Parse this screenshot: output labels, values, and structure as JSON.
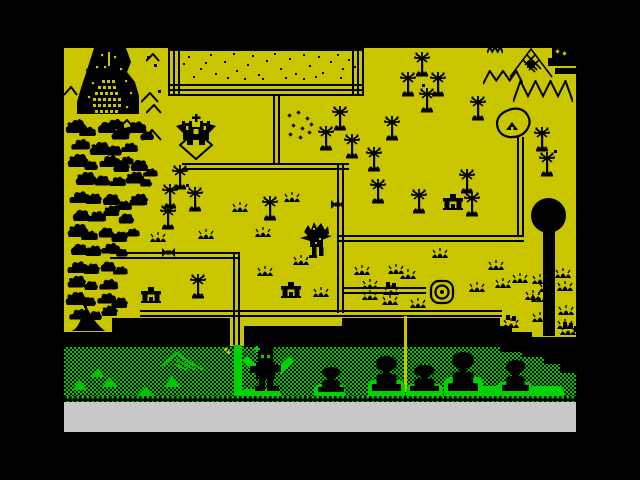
{
  "palette": {
    "yellow": "#c9c600",
    "green": "#00c400",
    "bright_green": "#00d400",
    "gray": "#c8c8c8",
    "black": "#000000"
  },
  "scene": {
    "screen": {
      "x": 64,
      "y": 48,
      "w": 512,
      "h": 384
    },
    "map": {
      "x": 64,
      "y": 48,
      "w": 512,
      "h": 270
    },
    "yellow_patches": [
      [
        64,
        318,
        48,
        14
      ],
      [
        238,
        318,
        104,
        8
      ],
      [
        500,
        318,
        76,
        8
      ],
      [
        512,
        326,
        62,
        6
      ],
      [
        532,
        332,
        44,
        5
      ],
      [
        230,
        316,
        14,
        30
      ]
    ],
    "checker_band": {
      "x": 64,
      "y": 347,
      "w": 512,
      "h": 51
    },
    "black_steps": [
      [
        500,
        347,
        76,
        5
      ],
      [
        522,
        352,
        54,
        5
      ],
      [
        544,
        357,
        32,
        7
      ],
      [
        560,
        364,
        16,
        9
      ]
    ],
    "dotted_row": {
      "x": 64,
      "y": 396,
      "w": 512,
      "h": 6
    },
    "gray_bar": {
      "x": 64,
      "y": 402,
      "w": 512,
      "h": 30
    },
    "field": {
      "x": 168,
      "y": 48,
      "w": 196,
      "h": 48,
      "dots": [
        [
          20,
          8
        ],
        [
          32,
          20
        ],
        [
          42,
          6
        ],
        [
          47,
          25
        ],
        [
          56,
          13
        ],
        [
          65,
          5
        ],
        [
          68,
          22
        ],
        [
          79,
          16
        ],
        [
          84,
          7
        ],
        [
          90,
          26
        ],
        [
          98,
          12
        ],
        [
          106,
          5
        ],
        [
          112,
          20
        ],
        [
          121,
          10
        ],
        [
          127,
          25
        ],
        [
          135,
          6
        ],
        [
          141,
          17
        ],
        [
          150,
          8
        ],
        [
          154,
          24
        ],
        [
          162,
          13
        ],
        [
          169,
          6
        ],
        [
          174,
          20
        ],
        [
          180,
          11
        ],
        [
          37,
          14
        ],
        [
          59,
          29
        ],
        [
          94,
          30
        ],
        [
          117,
          29
        ],
        [
          147,
          28
        ],
        [
          25,
          28
        ],
        [
          172,
          29
        ],
        [
          186,
          18
        ],
        [
          15,
          15
        ],
        [
          135,
          30
        ],
        [
          76,
          30
        ]
      ]
    },
    "paths": [
      {
        "x": 273,
        "y": 95,
        "len": 70,
        "o": "v"
      },
      {
        "x": 182,
        "y": 163,
        "len": 167,
        "o": "h"
      },
      {
        "x": 337,
        "y": 163,
        "len": 150,
        "o": "v"
      },
      {
        "x": 337,
        "y": 235,
        "len": 187,
        "o": "h"
      },
      {
        "x": 517,
        "y": 137,
        "len": 100,
        "o": "v"
      },
      {
        "x": 140,
        "y": 310,
        "len": 362,
        "o": "h"
      },
      {
        "x": 110,
        "y": 252,
        "len": 130,
        "o": "h"
      },
      {
        "x": 233,
        "y": 252,
        "len": 93,
        "o": "v"
      },
      {
        "x": 342,
        "y": 287,
        "len": 84,
        "o": "h"
      }
    ],
    "gates": [
      [
        331,
        198
      ],
      [
        162,
        246
      ]
    ],
    "trees": [
      [
        413,
        52
      ],
      [
        399,
        72
      ],
      [
        429,
        72
      ],
      [
        418,
        88
      ],
      [
        469,
        96
      ],
      [
        331,
        106
      ],
      [
        317,
        126
      ],
      [
        343,
        134
      ],
      [
        383,
        116
      ],
      [
        365,
        147
      ],
      [
        533,
        127
      ],
      [
        538,
        152
      ],
      [
        458,
        169
      ],
      [
        369,
        179
      ],
      [
        410,
        189
      ],
      [
        463,
        192
      ],
      [
        171,
        165
      ],
      [
        161,
        184
      ],
      [
        186,
        187
      ],
      [
        159,
        205
      ],
      [
        261,
        196
      ],
      [
        189,
        274
      ]
    ],
    "tufts": [
      [
        284,
        192
      ],
      [
        232,
        202
      ],
      [
        255,
        227
      ],
      [
        293,
        255
      ],
      [
        257,
        266
      ],
      [
        313,
        287
      ],
      [
        198,
        229
      ],
      [
        150,
        232
      ],
      [
        354,
        265
      ],
      [
        388,
        264
      ],
      [
        362,
        279
      ],
      [
        400,
        269
      ],
      [
        362,
        290
      ],
      [
        382,
        295
      ],
      [
        410,
        298
      ],
      [
        432,
        248
      ],
      [
        469,
        282
      ],
      [
        488,
        260
      ],
      [
        495,
        278
      ],
      [
        512,
        273
      ],
      [
        525,
        290
      ],
      [
        539,
        282
      ],
      [
        555,
        268
      ],
      [
        557,
        281
      ],
      [
        558,
        305
      ],
      [
        557,
        319
      ],
      [
        532,
        274
      ],
      [
        531,
        292
      ],
      [
        532,
        312
      ]
    ],
    "weeds": [
      [
        383,
        282
      ],
      [
        503,
        315
      ],
      [
        560,
        322
      ]
    ],
    "bushes": [
      [
        64,
        118,
        0,
        1
      ],
      [
        78,
        124,
        1,
        0.8
      ],
      [
        95,
        118,
        2,
        1
      ],
      [
        110,
        126,
        0,
        0.9
      ],
      [
        124,
        118,
        1,
        1
      ],
      [
        138,
        128,
        2,
        0.8
      ],
      [
        70,
        136,
        1,
        0.9
      ],
      [
        88,
        140,
        0,
        1
      ],
      [
        104,
        142,
        2,
        0.9
      ],
      [
        120,
        140,
        1,
        0.8
      ],
      [
        66,
        152,
        0,
        1
      ],
      [
        82,
        158,
        2,
        0.8
      ],
      [
        98,
        152,
        1,
        1
      ],
      [
        112,
        160,
        0,
        0.8
      ],
      [
        128,
        156,
        2,
        1
      ],
      [
        142,
        166,
        1,
        0.7
      ],
      [
        74,
        170,
        0,
        1
      ],
      [
        92,
        172,
        2,
        0.9
      ],
      [
        108,
        174,
        1,
        0.8
      ],
      [
        124,
        170,
        0,
        0.9
      ],
      [
        138,
        176,
        2,
        0.7
      ],
      [
        68,
        188,
        1,
        1
      ],
      [
        84,
        192,
        0,
        0.8
      ],
      [
        100,
        190,
        2,
        1
      ],
      [
        114,
        198,
        1,
        0.8
      ],
      [
        128,
        192,
        0,
        0.9
      ],
      [
        70,
        206,
        2,
        1
      ],
      [
        86,
        208,
        1,
        0.9
      ],
      [
        102,
        204,
        0,
        0.8
      ],
      [
        116,
        210,
        2,
        0.9
      ],
      [
        66,
        222,
        0,
        1
      ],
      [
        80,
        228,
        1,
        0.8
      ],
      [
        96,
        224,
        2,
        0.9
      ],
      [
        110,
        230,
        0,
        0.8
      ],
      [
        124,
        226,
        1,
        0.7
      ],
      [
        68,
        240,
        2,
        1
      ],
      [
        84,
        244,
        0,
        0.8
      ],
      [
        100,
        240,
        1,
        0.9
      ],
      [
        114,
        246,
        2,
        0.7
      ],
      [
        66,
        258,
        1,
        1
      ],
      [
        82,
        262,
        0,
        0.8
      ],
      [
        98,
        258,
        2,
        0.9
      ],
      [
        112,
        264,
        1,
        0.7
      ],
      [
        66,
        274,
        0,
        0.9
      ],
      [
        82,
        278,
        2,
        0.8
      ],
      [
        98,
        276,
        1,
        0.9
      ],
      [
        64,
        290,
        0,
        1
      ],
      [
        80,
        294,
        2,
        0.8
      ],
      [
        96,
        290,
        1,
        0.9
      ],
      [
        110,
        296,
        0,
        0.8
      ],
      [
        68,
        306,
        1,
        0.9
      ],
      [
        86,
        308,
        2,
        0.8
      ],
      [
        100,
        304,
        0,
        0.8
      ],
      [
        104,
        116,
        1,
        0.9
      ],
      [
        118,
        154,
        1,
        0.7
      ]
    ],
    "chevrons": [
      [
        64,
        86,
        14,
        10
      ],
      [
        86,
        64,
        12,
        8
      ],
      [
        141,
        92,
        18,
        11
      ],
      [
        146,
        104,
        16,
        10
      ],
      [
        71,
        119,
        17,
        11
      ],
      [
        117,
        119,
        20,
        12
      ],
      [
        142,
        129,
        20,
        12
      ],
      [
        146,
        53,
        14,
        9
      ]
    ],
    "zigzags": [
      [
        483,
        70,
        40,
        15,
        3
      ],
      [
        513,
        80,
        60,
        23,
        4
      ],
      [
        487,
        46,
        16,
        8,
        3
      ]
    ],
    "hatch_mountain": {
      "x": 509,
      "y": 48,
      "w": 44,
      "h": 30
    },
    "corner_blob": {
      "x": 548,
      "y": 46,
      "w": 28,
      "h": 30
    },
    "specks": [
      [
        288,
        114
      ],
      [
        297,
        111
      ],
      [
        306,
        117
      ],
      [
        292,
        124
      ],
      [
        301,
        127
      ],
      [
        310,
        123
      ],
      [
        289,
        133
      ],
      [
        299,
        136
      ],
      [
        308,
        131
      ]
    ],
    "dots": [
      [
        186,
        184
      ],
      [
        554,
        150
      ],
      [
        422,
        84
      ],
      [
        147,
        56
      ],
      [
        154,
        64
      ],
      [
        158,
        90
      ]
    ],
    "houses": [
      [
        443,
        194
      ],
      [
        281,
        282
      ],
      [
        141,
        287
      ]
    ],
    "castle": {
      "x": 68,
      "y": 42,
      "w": 78,
      "h": 78
    },
    "left_mountain": {
      "x": 71,
      "y": 304,
      "w": 34,
      "h": 27
    },
    "church": {
      "x": 176,
      "y": 114,
      "w": 40,
      "h": 48
    },
    "gnarly": {
      "x": 300,
      "y": 222,
      "w": 32,
      "h": 36
    },
    "well": {
      "x": 429,
      "y": 279,
      "w": 26,
      "h": 26
    },
    "cave": {
      "x": 495,
      "y": 107,
      "w": 38,
      "h": 34
    },
    "lollipop": {
      "x": 531,
      "y": 198,
      "d": 35,
      "trunk": [
        543,
        230,
        12,
        106
      ]
    },
    "green_solids": [
      [
        72,
        380,
        15,
        10
      ],
      [
        91,
        368,
        14,
        9
      ],
      [
        102,
        377,
        16,
        10
      ],
      [
        136,
        387,
        19,
        10
      ],
      [
        164,
        375,
        16,
        12
      ]
    ],
    "green_ridge": {
      "x": 162,
      "y": 352,
      "w": 44,
      "h": 20
    },
    "green_path": {
      "x": 234,
      "y": 345,
      "w": 8,
      "h": 53
    },
    "mounds": [
      [
        460,
        386,
        104,
        11
      ],
      [
        240,
        389,
        41,
        8
      ],
      [
        314,
        384,
        31,
        13
      ],
      [
        368,
        380,
        37,
        17
      ],
      [
        406,
        384,
        37,
        13
      ],
      [
        444,
        377,
        39,
        20
      ],
      [
        497,
        382,
        35,
        15
      ]
    ],
    "huts": [
      [
        318,
        367,
        26,
        25
      ],
      [
        372,
        356,
        29,
        35
      ],
      [
        410,
        365,
        29,
        26
      ],
      [
        448,
        352,
        30,
        39
      ],
      [
        502,
        360,
        27,
        31
      ]
    ],
    "warrior": {
      "x": 241,
      "y": 344,
      "w": 54,
      "h": 50
    },
    "yellow_line": [
      404,
      316,
      3,
      76
    ],
    "yellow_specks": [
      [
        224,
        348
      ],
      [
        227,
        351
      ]
    ]
  }
}
